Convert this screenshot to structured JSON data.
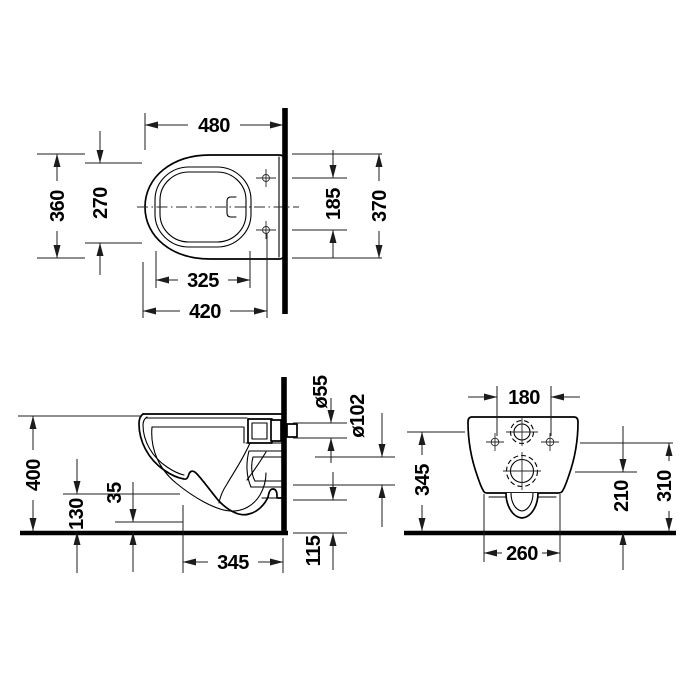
{
  "drawing": {
    "colors": {
      "background": "#ffffff",
      "line": "#000000"
    },
    "dims": {
      "top": {
        "overall_depth": "480",
        "outer_width": "360",
        "inner_width": "270",
        "hole_spacing": "185",
        "rim_depth": "370",
        "inner_length": "325",
        "hole_offset_from_front": "420"
      },
      "side": {
        "height": "400",
        "rear_bottom_height": "130",
        "bottom_clearance": "35",
        "projection": "345",
        "outlet_bottom_height": "115",
        "supply_diameter": "ø55",
        "outlet_diameter": "ø102"
      },
      "rear": {
        "hole_spacing": "180",
        "supply_height": "345",
        "outlet_height": "210",
        "hole_height": "310",
        "base_width": "260"
      }
    }
  }
}
